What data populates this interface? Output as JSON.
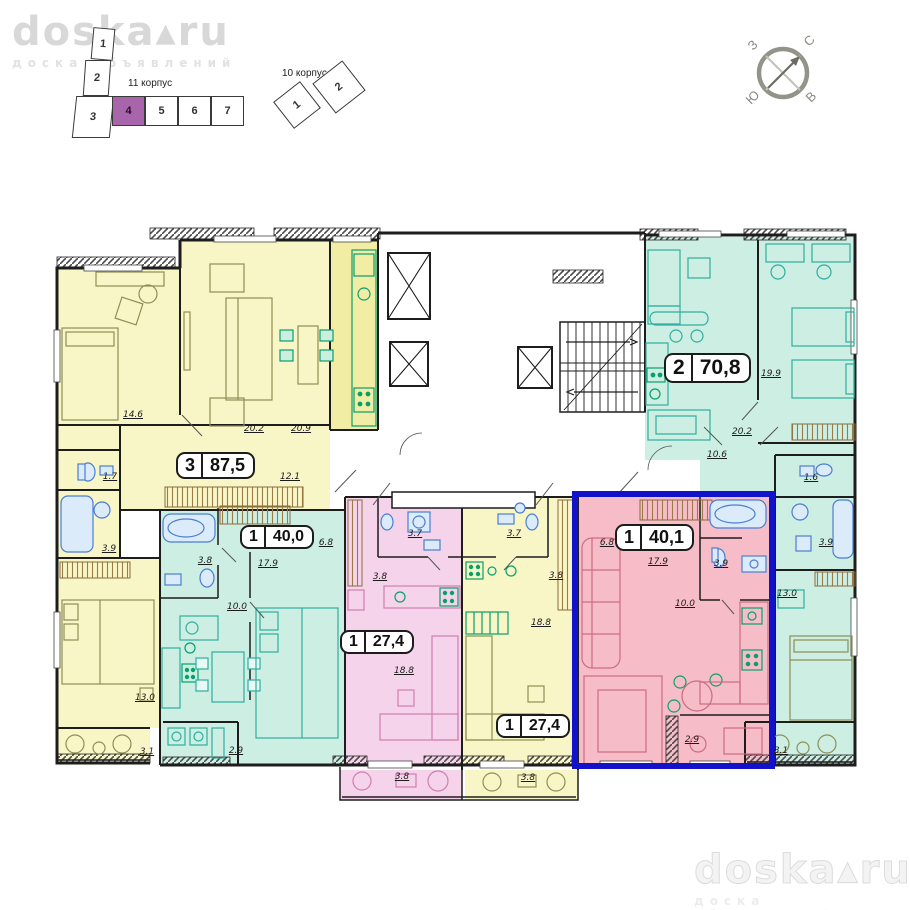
{
  "site": {
    "logo": "doska▴ru",
    "tagline": "доска объявлений"
  },
  "schematic": {
    "building11_label": "11 корпус",
    "building11_sections": [
      "1",
      "2",
      "3",
      "4",
      "5",
      "6",
      "7"
    ],
    "building11_highlighted_section": "4",
    "building10_label": "10 корпус",
    "building10_sections": [
      "1",
      "2"
    ]
  },
  "compass": {
    "north": "С",
    "south": "Ю",
    "west": "З",
    "east": "В"
  },
  "apartments": [
    {
      "id": "apt-87-5",
      "rooms": "3",
      "area": "87,5",
      "color": "#f8f6c6",
      "highlighted": false
    },
    {
      "id": "apt-40-0",
      "rooms": "1",
      "area": "40,0",
      "color": "#cceee3",
      "highlighted": false
    },
    {
      "id": "apt-70-8",
      "rooms": "2",
      "area": "70,8",
      "color": "#cceee3",
      "highlighted": false
    },
    {
      "id": "apt-27-4-left",
      "rooms": "1",
      "area": "27,4",
      "color": "#f5d3eb",
      "highlighted": false
    },
    {
      "id": "apt-27-4-right",
      "rooms": "1",
      "area": "27,4",
      "color": "#f8f6c6",
      "highlighted": false
    },
    {
      "id": "apt-40-1",
      "rooms": "1",
      "area": "40,1",
      "color": "#f6bdc8",
      "highlighted": true
    }
  ],
  "colors": {
    "highlight_border": "#1212cb",
    "section_highlight": "#a965ac"
  },
  "room_areas": [
    {
      "apt": "87,5",
      "v": "14.6",
      "x": 133,
      "y": 415
    },
    {
      "apt": "87,5",
      "v": "20.2",
      "x": 254,
      "y": 429
    },
    {
      "apt": "87,5",
      "v": "20.9",
      "x": 301,
      "y": 429
    },
    {
      "apt": "87,5",
      "v": "12.1",
      "x": 290,
      "y": 477
    },
    {
      "apt": "87,5",
      "v": "1.7",
      "x": 110,
      "y": 477
    },
    {
      "apt": "87,5",
      "v": "3.9",
      "x": 109,
      "y": 549
    },
    {
      "apt": "87,5",
      "v": "13.0",
      "x": 145,
      "y": 698
    },
    {
      "apt": "87,5",
      "v": "3.1",
      "x": 147,
      "y": 752
    },
    {
      "apt": "40,0",
      "v": "6.8",
      "x": 326,
      "y": 543
    },
    {
      "apt": "40,0",
      "v": "3.8",
      "x": 205,
      "y": 561
    },
    {
      "apt": "40,0",
      "v": "17.9",
      "x": 268,
      "y": 564
    },
    {
      "apt": "40,0",
      "v": "10.0",
      "x": 237,
      "y": 607
    },
    {
      "apt": "40,0",
      "v": "2.9",
      "x": 236,
      "y": 751
    },
    {
      "apt": "27,4 left",
      "v": "3.7",
      "x": 415,
      "y": 534
    },
    {
      "apt": "27,4 left",
      "v": "3.8",
      "x": 380,
      "y": 577
    },
    {
      "apt": "27,4 left",
      "v": "18.8",
      "x": 404,
      "y": 671
    },
    {
      "apt": "27,4 left",
      "v": "3.8",
      "x": 402,
      "y": 777
    },
    {
      "apt": "27,4 right",
      "v": "3.7",
      "x": 514,
      "y": 534
    },
    {
      "apt": "27,4 right",
      "v": "3.8",
      "x": 556,
      "y": 576
    },
    {
      "apt": "27,4 right",
      "v": "18.8",
      "x": 541,
      "y": 623
    },
    {
      "apt": "27,4 right",
      "v": "3.8",
      "x": 528,
      "y": 778
    },
    {
      "apt": "40,1",
      "v": "6.8",
      "x": 607,
      "y": 543
    },
    {
      "apt": "40,1",
      "v": "17.9",
      "x": 658,
      "y": 562
    },
    {
      "apt": "40,1",
      "v": "3.9",
      "x": 721,
      "y": 564
    },
    {
      "apt": "40,1",
      "v": "10.0",
      "x": 685,
      "y": 604
    },
    {
      "apt": "40,1",
      "v": "2.9",
      "x": 692,
      "y": 740
    },
    {
      "apt": "70,8",
      "v": "19.9",
      "x": 771,
      "y": 374
    },
    {
      "apt": "70,8",
      "v": "20.2",
      "x": 742,
      "y": 432
    },
    {
      "apt": "70,8",
      "v": "10.6",
      "x": 717,
      "y": 455
    },
    {
      "apt": "70,8",
      "v": "1.6",
      "x": 811,
      "y": 478
    },
    {
      "apt": "70,8",
      "v": "3.9",
      "x": 826,
      "y": 543
    },
    {
      "apt": "70,8",
      "v": "13.0",
      "x": 787,
      "y": 594
    },
    {
      "apt": "70,8",
      "v": "3.1",
      "x": 781,
      "y": 751
    }
  ]
}
